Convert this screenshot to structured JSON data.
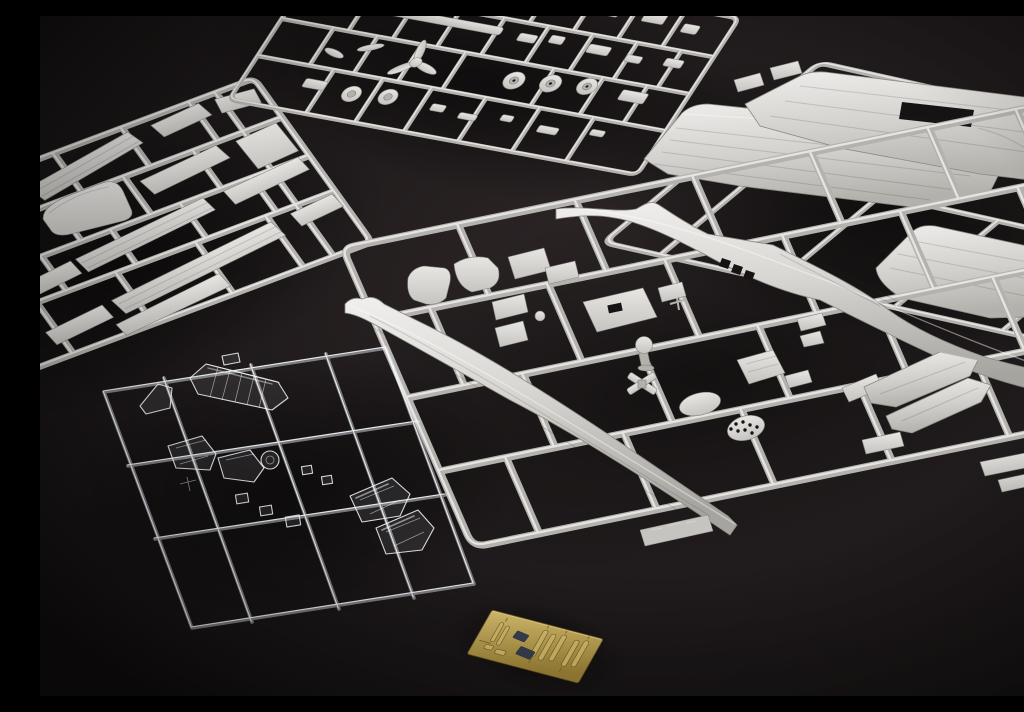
{
  "scene": {
    "description": "Unassembled plastic scale-model aircraft kit photographed on a dark grey surface: four grey styrene sprues of parts, one clear styrene sprue of canopy glazing, and a small brass photo-etched detail fret"
  },
  "colors": {
    "bg-dark": "#131011",
    "bg-mid": "#1f1a1b",
    "bg-light": "#2f2829",
    "styrene-light": "#e7e6e3",
    "styrene-base": "#c6c4c0",
    "styrene-dark": "#989590",
    "runner-core": "#b4b2ae",
    "runner-hi": "#edecea",
    "clear-stroke": "rgba(248,250,253,0.85)",
    "clear-fill": "rgba(205,214,228,0.10)",
    "brass-light": "#d9c06c",
    "brass-base": "#b2973f",
    "brass-dark": "#735d24",
    "pe-film": "#3a4152"
  },
  "sprues": [
    {
      "id": "A",
      "name": "sprue-control-surfaces",
      "material": "grey-styrene",
      "position": "upper-left",
      "description": "Flat pieces: tailplanes, flaps, ailerons and hatch covers"
    },
    {
      "id": "B",
      "name": "sprue-small-parts",
      "material": "grey-styrene",
      "position": "top-centre",
      "description": "Small fittings: propeller, blades, wheels and brackets"
    },
    {
      "id": "C",
      "name": "sprue-wing-panels",
      "material": "grey-styrene",
      "position": "upper-right",
      "description": "Large upper and lower wing halves with spar slot"
    },
    {
      "id": "D",
      "name": "sprue-fuselage",
      "material": "grey-styrene",
      "position": "centre",
      "description": "Two long fuselage halves, cockpit interior parts, tail fins and a perforated bulkhead"
    },
    {
      "id": "E",
      "name": "sprue-clear-parts",
      "material": "clear-styrene",
      "position": "lower-left",
      "description": "Glazing: segmented greenhouse canopy, windscreens and lamp covers"
    },
    {
      "id": "F",
      "name": "photo-etch-fret",
      "material": "brass-photo-etch",
      "position": "bottom-centre",
      "description": "Etched brass harness straps and instrument panels"
    }
  ]
}
